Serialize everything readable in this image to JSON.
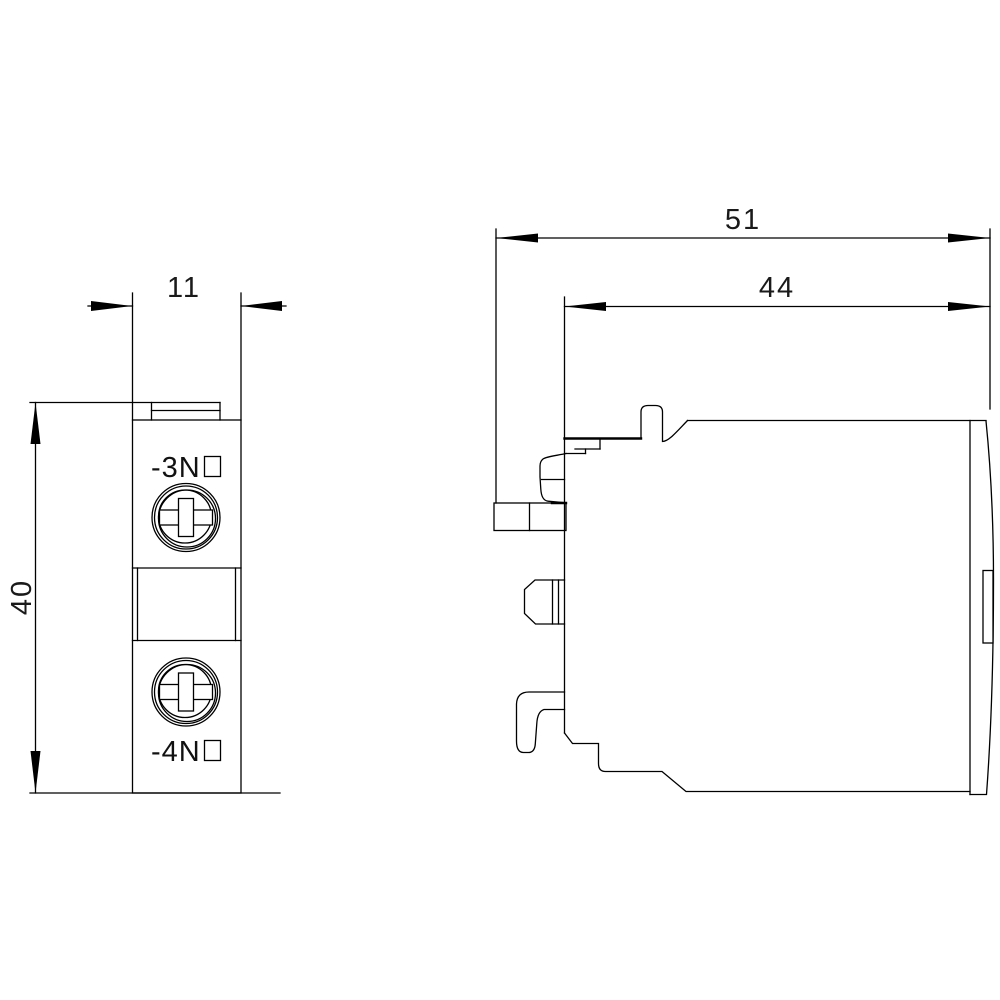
{
  "colors": {
    "line": "#000000",
    "background": "#ffffff"
  },
  "front_view": {
    "width_dim": "11",
    "height_dim": "40",
    "terminal_top_label": "-3N",
    "terminal_top_symbol": "open-box",
    "terminal_bottom_label": "-4N",
    "terminal_bottom_symbol": "open-box"
  },
  "side_view": {
    "overall_depth_dim": "51",
    "body_depth_dim": "44"
  }
}
